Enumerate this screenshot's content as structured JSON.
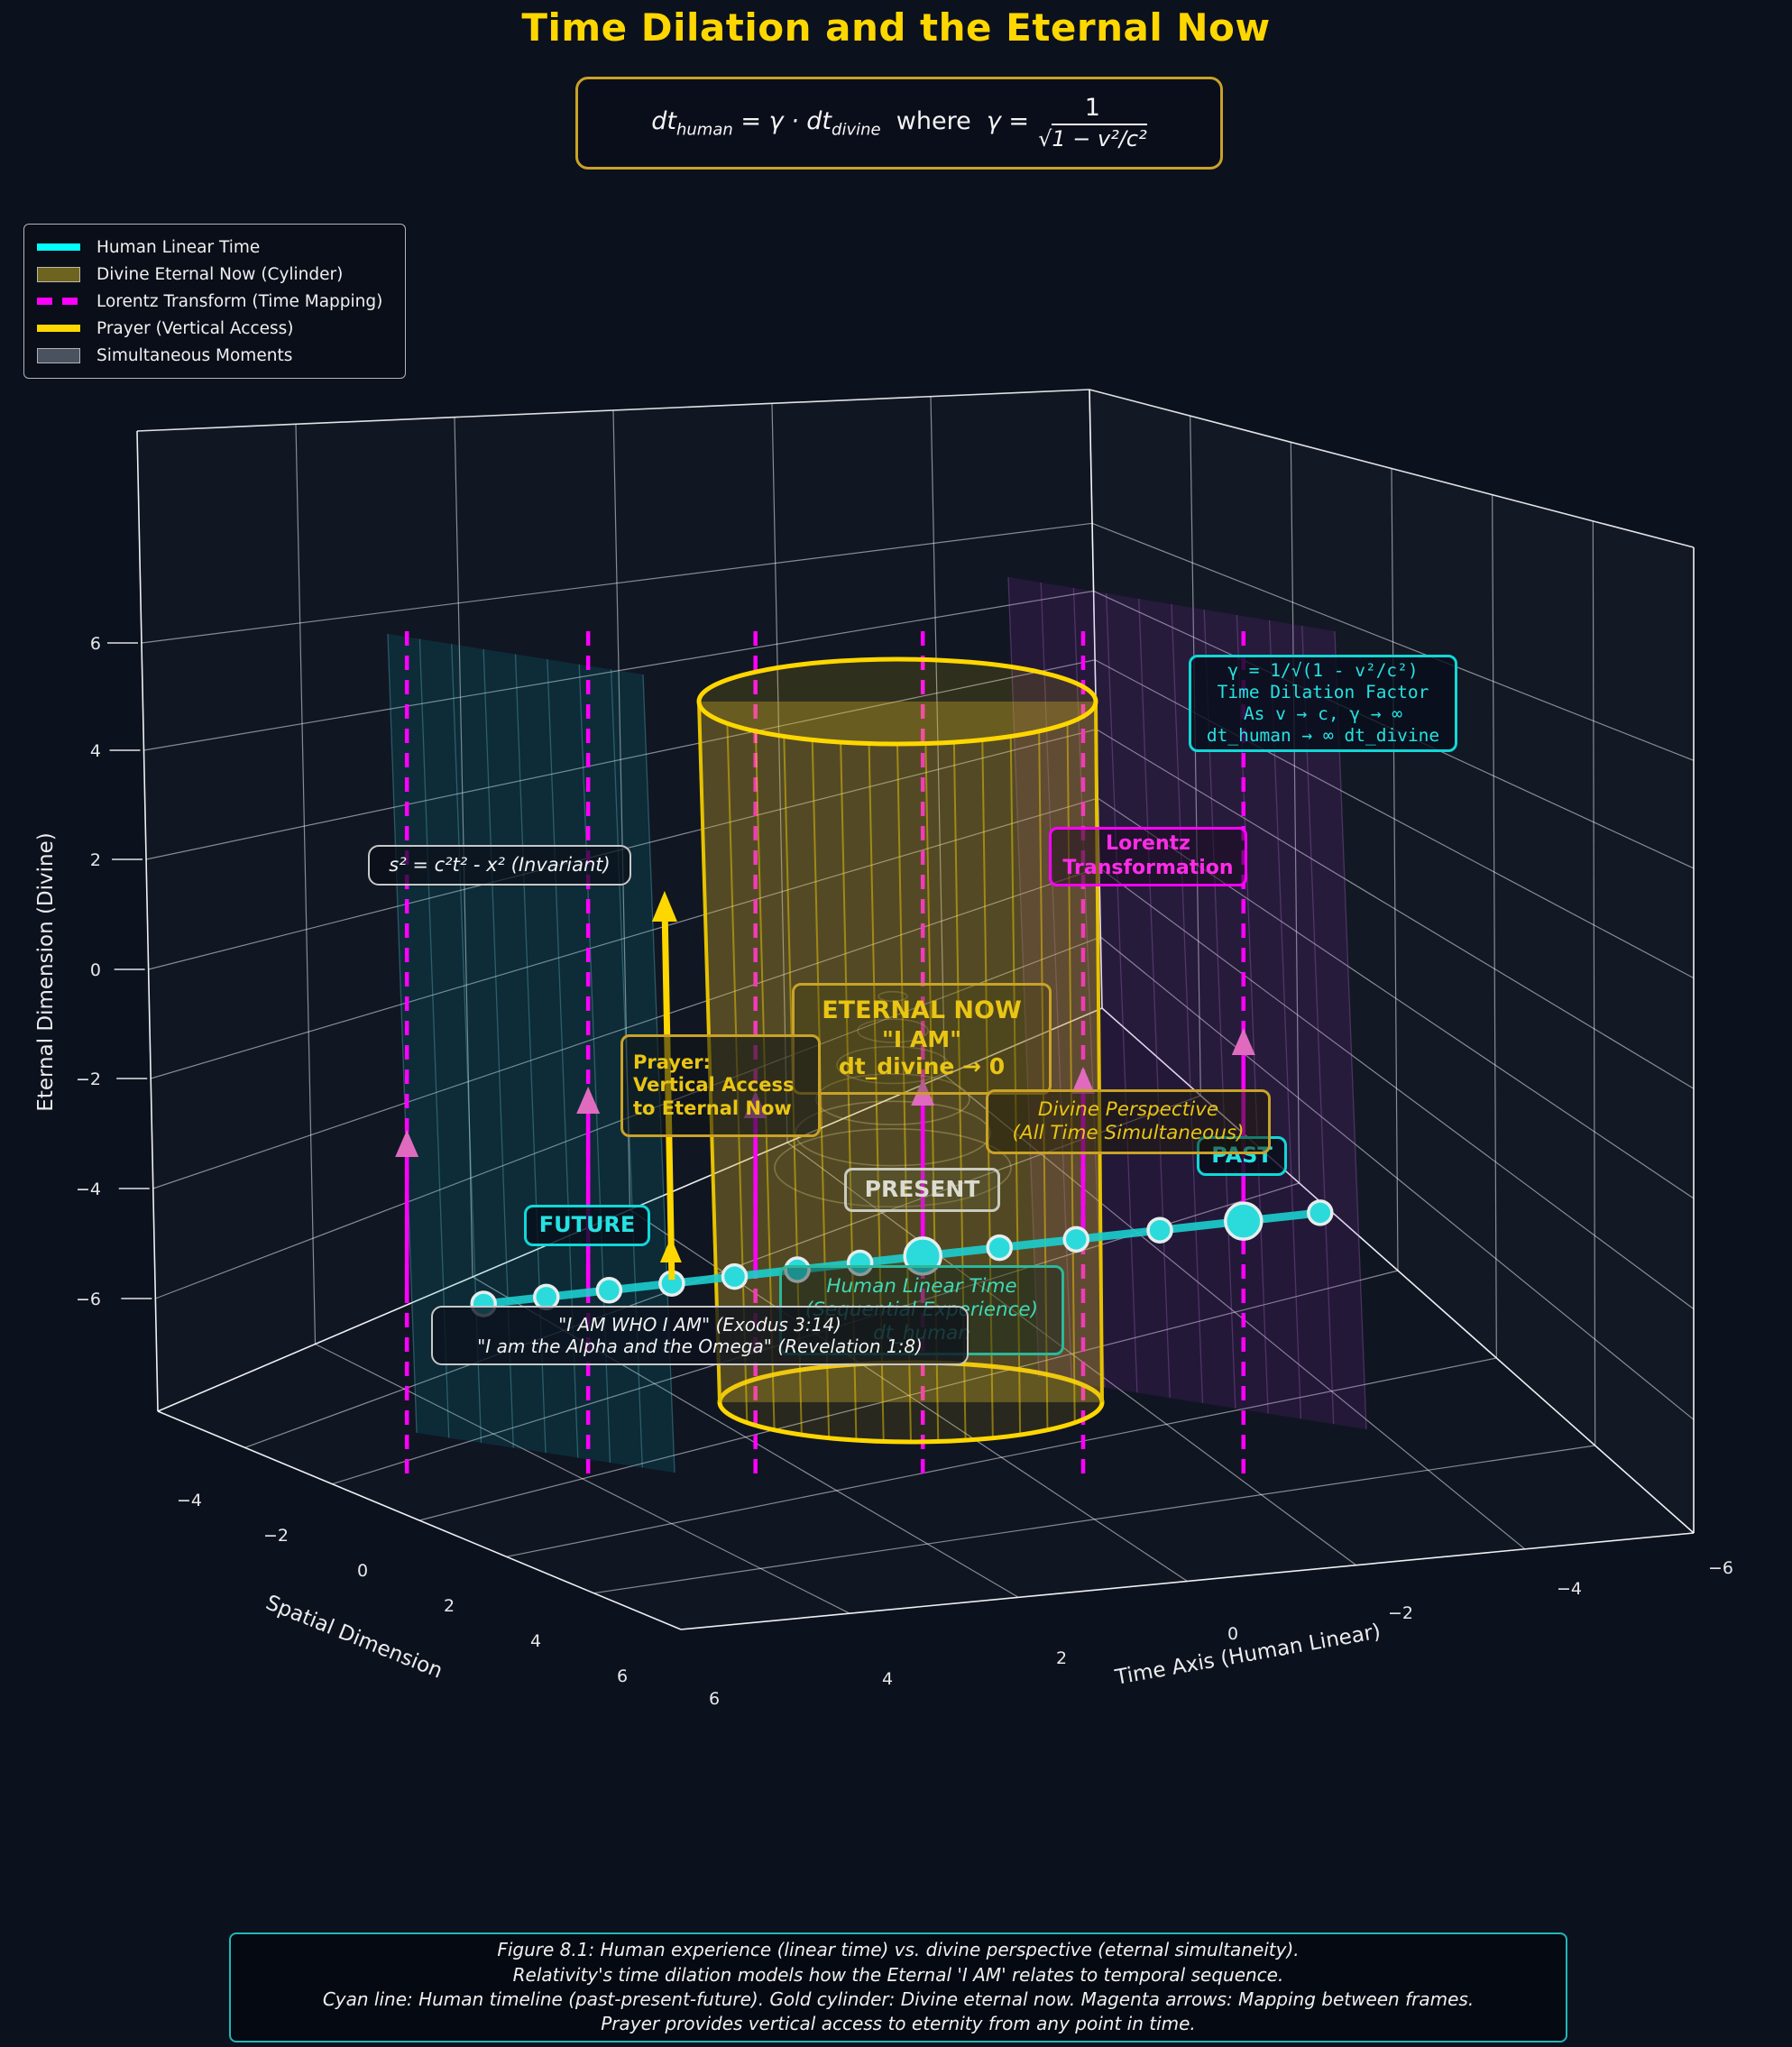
{
  "colors": {
    "background": "#0c111e",
    "gold": "#FFD700",
    "gold_edge": "#C9A227",
    "cyan": "#00FFFF",
    "timeline": "#1CCFCF",
    "dot_fill": "#2BDBDB",
    "dot_ring": "#E6EDED",
    "magenta": "#FF00FF",
    "arrowhead": "#E06BBE",
    "teal_plane": "rgba(0,150,160,0.17)",
    "teal_plane_line": "rgba(110,220,230,0.30)",
    "purple_plane": "rgba(150,50,190,0.15)",
    "purple_plane_line": "rgba(215,130,240,0.25)",
    "grid": "rgba(255,255,255,0.5)",
    "pane_edge": "rgba(255,255,255,0.88)",
    "tick_text": "#E8E8E8",
    "cyl_body": "rgba(212,175,40,0.34)",
    "cyl_line": "rgba(255,215,0,0.45)",
    "spiral": "rgba(235,215,140,0.30)"
  },
  "header": {
    "title": "Time Dilation and the Eternal Now",
    "formula": {
      "p1": "dt",
      "s1": "human",
      "p2": " = γ · dt",
      "s2": "divine",
      "p3": "where",
      "p4": "γ =",
      "num": "1",
      "sqrt": "√",
      "den": "1 − v²/c²"
    }
  },
  "legend": {
    "items": [
      {
        "label": "Human Linear Time",
        "type": "line",
        "color": "#00FFFF"
      },
      {
        "label": "Divine Eternal Now (Cylinder)",
        "type": "patch",
        "color": "#6E6420"
      },
      {
        "label": "Lorentz Transform (Time Mapping)",
        "type": "dashed",
        "color": "#FF00FF"
      },
      {
        "label": "Prayer (Vertical Access)",
        "type": "line",
        "color": "#FFD700"
      },
      {
        "label": "Simultaneous Moments",
        "type": "patch",
        "color": "#4A5260"
      }
    ]
  },
  "axes": {
    "time": {
      "label": "Time Axis (Human Linear)",
      "ticks": [
        "6",
        "4",
        "2",
        "0",
        "−2",
        "−4",
        "−6"
      ]
    },
    "spatial": {
      "label": "Spatial Dimension",
      "ticks": [
        "−4",
        "−2",
        "0",
        "2",
        "4",
        "6"
      ]
    },
    "eternal": {
      "label": "Eternal Dimension (Divine)",
      "ticks": [
        "6",
        "4",
        "2",
        "0",
        "−2",
        "−4",
        "−6"
      ]
    }
  },
  "annotations": {
    "gamma": {
      "lines": [
        "γ = 1/√(1 - v²/c²)",
        "Time Dilation Factor",
        "As v → c, γ → ∞",
        "dt_human → ∞ dt_divine"
      ]
    },
    "lorentz": {
      "lines": [
        "Lorentz",
        "Transformation"
      ]
    },
    "invariant": {
      "text": "s² = c²t² - x² (Invariant)"
    },
    "eternal_now": {
      "lines": [
        "ETERNAL NOW",
        "\"I AM\"",
        "dt_divine → 0"
      ]
    },
    "prayer": {
      "lines": [
        "Prayer:",
        "Vertical Access",
        "to Eternal Now"
      ]
    },
    "future": {
      "text": "FUTURE"
    },
    "present": {
      "text": "PRESENT"
    },
    "past": {
      "text": "PAST"
    },
    "divine_perspective": {
      "lines": [
        "Divine Perspective",
        "(All Time Simultaneous)"
      ]
    },
    "human_linear": {
      "lines": [
        "Human Linear Time",
        "(Sequential Experience)",
        "dt_human"
      ]
    },
    "quotes": {
      "lines": [
        "\"I AM WHO I AM\" (Exodus 3:14)",
        "\"I am the Alpha and the Omega\" (Revelation 1:8)"
      ]
    }
  },
  "caption": {
    "lines": [
      "Figure 8.1: Human experience (linear time) vs. divine perspective (eternal simultaneity).",
      "Relativity's time dilation models how the Eternal 'I AM' relates to temporal sequence.",
      "Cyan line: Human timeline (past-present-future). Gold cylinder: Divine eternal now. Magenta arrows: Mapping between frames.",
      "Prayer provides vertical access to eternity from any point in time."
    ]
  },
  "chart_data": {
    "type": "line",
    "title": "Time Dilation and the Eternal Now",
    "description": "3D conceptual plot: cyan human timeline crossing a gold 'Eternal Now' cylinder, with magenta Lorentz-mapping arrows and a gold prayer arrow",
    "axis_ranges": {
      "time": [
        -6,
        6
      ],
      "spatial": [
        -6,
        6
      ],
      "eternal": [
        -6,
        6
      ]
    },
    "timeline": {
      "t": [
        6,
        5.1,
        4.2,
        3.3,
        2.4,
        1.5,
        0.6,
        -0.3,
        -1.4,
        -2.5,
        -3.7,
        -4.9,
        -6
      ],
      "big_indices": [
        7,
        11
      ]
    },
    "mapping_lines_t": [
      7.1,
      4.5,
      2.1,
      -0.3,
      -2.6,
      -4.9
    ],
    "prayer_t": 3.3,
    "cylinder": {
      "center_t": 0,
      "radius": 2.8
    },
    "legend_position": "upper left",
    "grid": true
  }
}
